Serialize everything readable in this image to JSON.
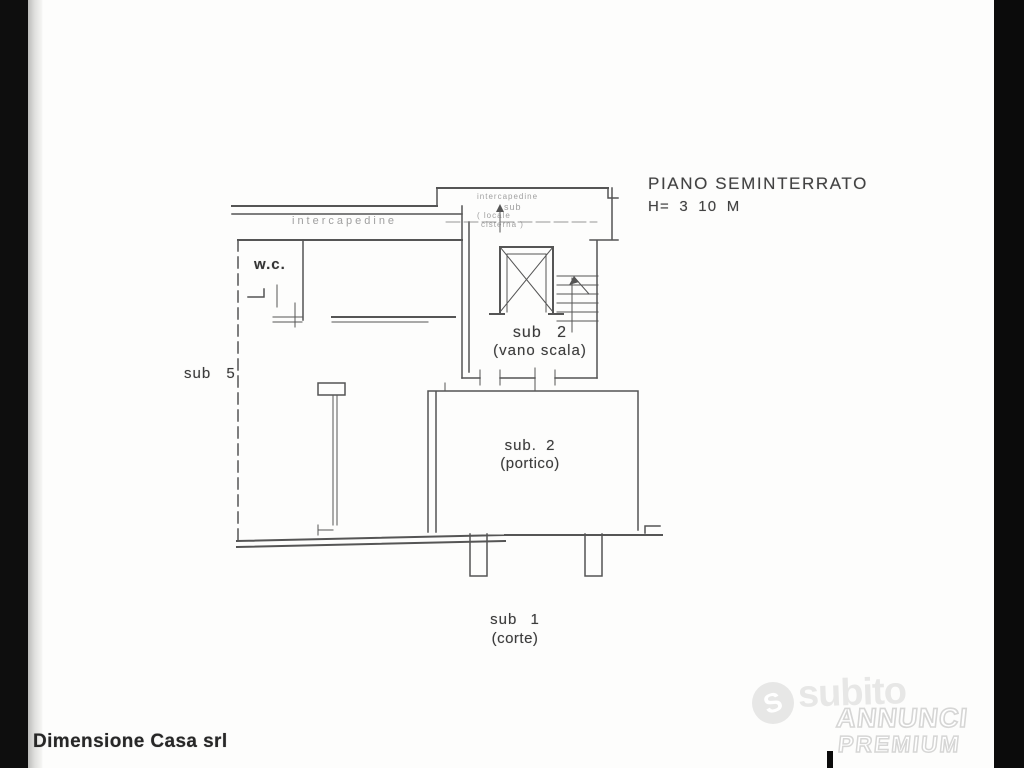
{
  "plan": {
    "title": "PIANO SEMINTERRATO",
    "height_note": "H= 3 10 M",
    "line_color": "#474747",
    "rooms": {
      "wc": "w.c.",
      "sub5": "sub 5",
      "vano_scala_1": "sub 2",
      "vano_scala_2": "(vano scala)",
      "portico_1": "sub. 2",
      "portico_2": "(portico)",
      "corte_1": "sub 1",
      "corte_2": "(corte)",
      "intercapedine_left": "intercapedine",
      "intercapedine_top": "intercapedine",
      "cisterna_1": "sub",
      "cisterna_2": "( locale",
      "cisterna_3": "cisterna )"
    }
  },
  "footer": {
    "company": "Dimensione Casa srl"
  },
  "watermark": {
    "logo_letter": "S",
    "brand": "subito",
    "badge_top": "ANNUNCI",
    "badge_bottom": "PREMIUM"
  }
}
